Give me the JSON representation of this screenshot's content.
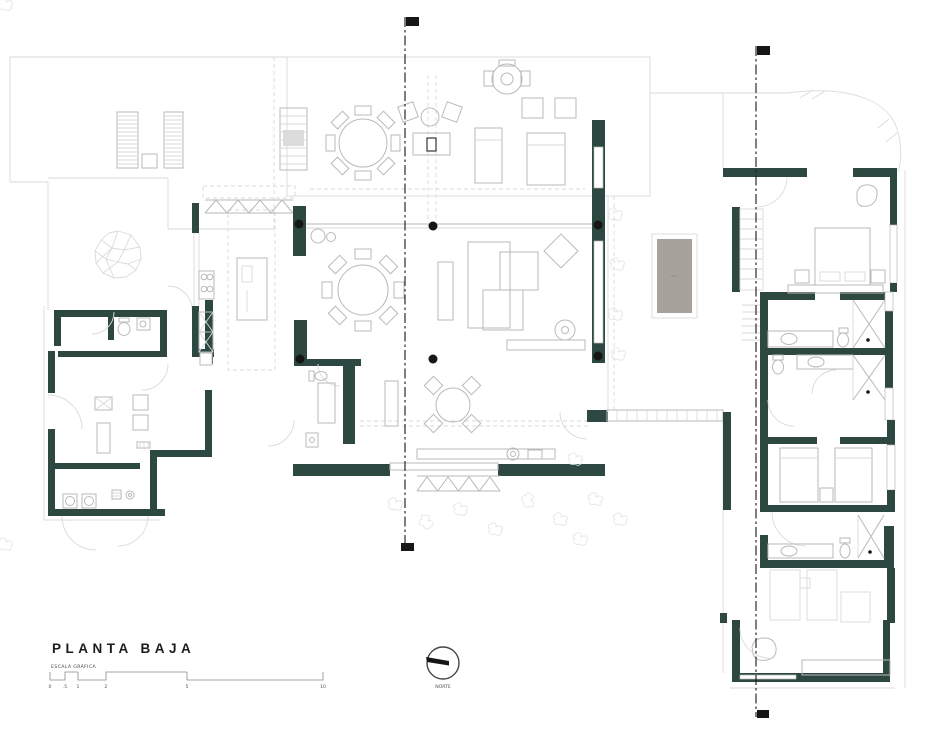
{
  "title": "PLANTA BAJA",
  "scale_bar": {
    "label": "ESCALA GRÁFICA",
    "ticks": [
      "0",
      ".5",
      "1",
      "2",
      "5",
      "10"
    ]
  },
  "north": {
    "label": "NORTE"
  },
  "colors": {
    "wall": "#2d4741",
    "pool": "#a8a29c",
    "line_light": "#dadada",
    "line_mid": "#b9b9b9",
    "ink": "#161616",
    "paper": "#ffffff"
  }
}
